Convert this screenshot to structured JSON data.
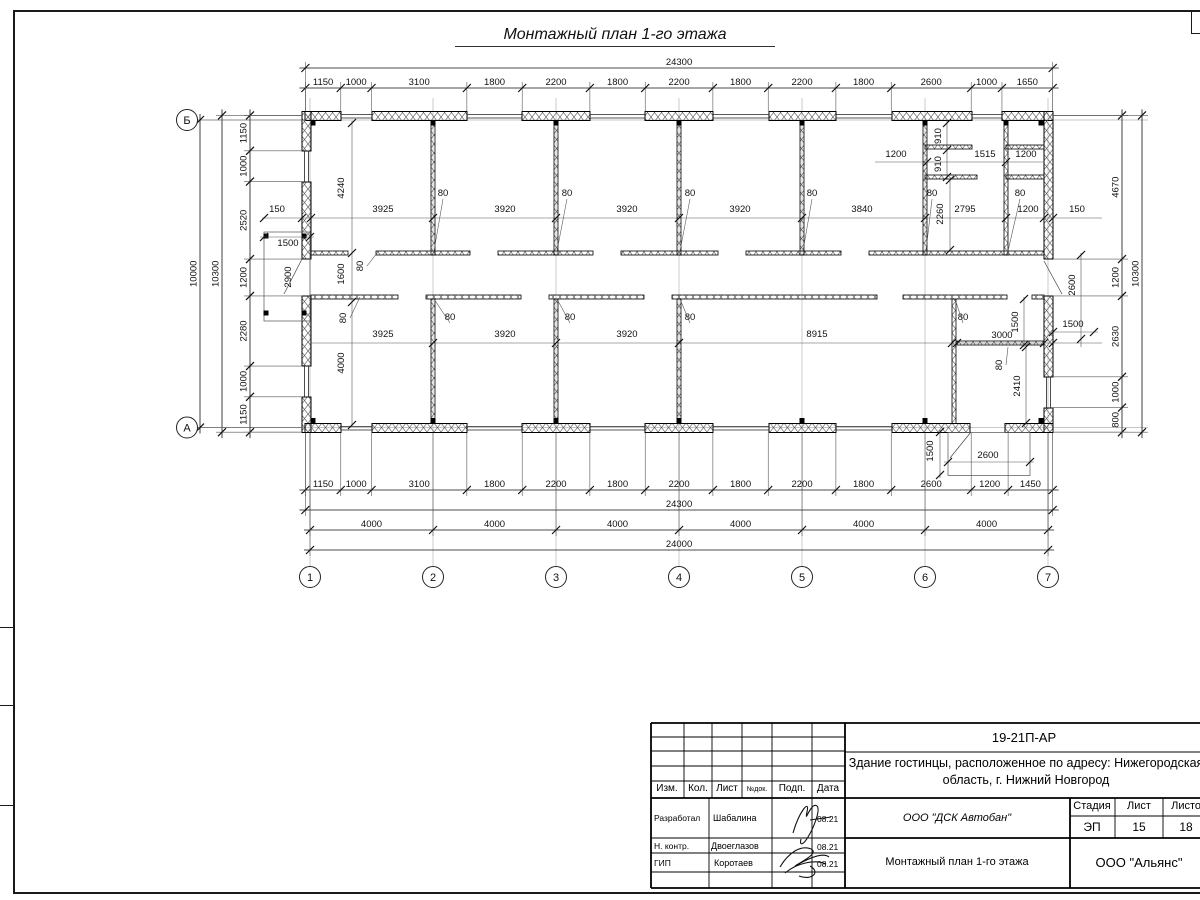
{
  "sheet": {
    "title": "Монтажный план 1-го этажа"
  },
  "plan": {
    "axes_bottom": [
      "1",
      "2",
      "3",
      "4",
      "5",
      "6",
      "7"
    ],
    "axes_left": [
      "Б",
      "А"
    ],
    "top_chain": [
      1150,
      1000,
      3100,
      1800,
      2200,
      1800,
      2200,
      1800,
      2200,
      1800,
      2600,
      1000,
      1650
    ],
    "top_total": 24300,
    "bottom_chain": [
      1150,
      1000,
      3100,
      1800,
      2200,
      1800,
      2200,
      1800,
      2200,
      1800,
      2600,
      1200,
      1450
    ],
    "bottom_total": 24300,
    "bottom_grid": [
      4000,
      4000,
      4000,
      4000,
      4000,
      4000
    ],
    "bottom_grid_total": 24000,
    "left_chain": [
      1150,
      1000,
      2520,
      1200,
      2280,
      1000,
      1150
    ],
    "left_total": 10300,
    "axis_span": 10000,
    "right_chain": [
      4670,
      1200,
      2630,
      1000,
      800
    ],
    "right_total": 10300,
    "free_labels": [
      {
        "t": "4240",
        "x": 344,
        "y": 188,
        "v": 1
      },
      {
        "t": "1600",
        "x": 344,
        "y": 274,
        "v": 1
      },
      {
        "t": "4000",
        "x": 344,
        "y": 363,
        "v": 1
      },
      {
        "t": "80",
        "x": 363,
        "y": 266,
        "v": 1,
        "l": [
          377,
          253
        ]
      },
      {
        "t": "80",
        "x": 346,
        "y": 318,
        "v": 1,
        "l": [
          360,
          297
        ]
      },
      {
        "t": "150",
        "x": 277,
        "y": 212
      },
      {
        "t": "1500",
        "x": 288,
        "y": 246
      },
      {
        "t": "2900",
        "x": 291,
        "y": 277,
        "v": 1
      },
      {
        "t": "3925",
        "x": 383,
        "y": 212
      },
      {
        "t": "80",
        "x": 443,
        "y": 196,
        "l": [
          434,
          251
        ]
      },
      {
        "t": "3920",
        "x": 505,
        "y": 212
      },
      {
        "t": "80",
        "x": 567,
        "y": 196,
        "l": [
          557,
          251
        ]
      },
      {
        "t": "3920",
        "x": 627,
        "y": 212
      },
      {
        "t": "80",
        "x": 690,
        "y": 196,
        "l": [
          680,
          251
        ]
      },
      {
        "t": "3920",
        "x": 740,
        "y": 212
      },
      {
        "t": "80",
        "x": 812,
        "y": 196,
        "l": [
          803,
          251
        ]
      },
      {
        "t": "3840",
        "x": 862,
        "y": 212
      },
      {
        "t": "80",
        "x": 932,
        "y": 196,
        "l": [
          926,
          251
        ]
      },
      {
        "t": "2795",
        "x": 965,
        "y": 212
      },
      {
        "t": "80",
        "x": 1020,
        "y": 196,
        "l": [
          1008,
          251
        ]
      },
      {
        "t": "1200",
        "x": 1028,
        "y": 212
      },
      {
        "t": "150",
        "x": 1077,
        "y": 212
      },
      {
        "t": "2260",
        "x": 943,
        "y": 214,
        "v": 1
      },
      {
        "t": "910",
        "x": 941,
        "y": 136,
        "v": 1
      },
      {
        "t": "910",
        "x": 941,
        "y": 164,
        "v": 1
      },
      {
        "t": "1200",
        "x": 896,
        "y": 157
      },
      {
        "t": "1515",
        "x": 985,
        "y": 157
      },
      {
        "t": "1200",
        "x": 1026,
        "y": 157
      },
      {
        "t": "3925",
        "x": 383,
        "y": 337
      },
      {
        "t": "80",
        "x": 450,
        "y": 320,
        "l": [
          434,
          299
        ]
      },
      {
        "t": "3920",
        "x": 505,
        "y": 337
      },
      {
        "t": "80",
        "x": 570,
        "y": 320,
        "l": [
          557,
          299
        ]
      },
      {
        "t": "3920",
        "x": 627,
        "y": 337
      },
      {
        "t": "80",
        "x": 690,
        "y": 320,
        "l": [
          680,
          299
        ]
      },
      {
        "t": "8915",
        "x": 817,
        "y": 337
      },
      {
        "t": "80",
        "x": 963,
        "y": 320,
        "l": [
          955,
          299
        ]
      },
      {
        "t": "3000",
        "x": 1002,
        "y": 338
      },
      {
        "t": "1500",
        "x": 1018,
        "y": 322,
        "v": 1
      },
      {
        "t": "2600",
        "x": 1075,
        "y": 285,
        "v": 1
      },
      {
        "t": "1500",
        "x": 1073,
        "y": 327
      },
      {
        "t": "80",
        "x": 1002,
        "y": 365,
        "v": 1,
        "l": [
          1008,
          347
        ]
      },
      {
        "t": "2410",
        "x": 1020,
        "y": 386,
        "v": 1
      },
      {
        "t": "1500",
        "x": 933,
        "y": 451,
        "v": 1
      },
      {
        "t": "2600",
        "x": 988,
        "y": 458
      }
    ]
  },
  "titleblock": {
    "doc_number": "19-21П-АР",
    "project_line1": "Здание гостинцы, расположенное по адресу: Нижегородская",
    "project_line2": "область, г. Нижний Новгород",
    "columns": [
      "Изм.",
      "Кол.",
      "Лист",
      "№док.",
      "Подп.",
      "Дата"
    ],
    "rows": [
      {
        "role": "Разработал",
        "name": "Шабалина",
        "date": "08.21"
      },
      {
        "role": "Н. контр.",
        "name": "Двоеглазов",
        "date": "08.21"
      },
      {
        "role": "ГИП",
        "name": "Коротаев",
        "date": "08.21"
      }
    ],
    "company": "ООО \"ДСК Автобан\"",
    "stage_label": "Стадия",
    "sheet_label": "Лист",
    "sheets_label": "Листов",
    "stage": "ЭП",
    "sheet": "15",
    "sheets": "18",
    "drawing_name": "Монтажный план 1-го этажа",
    "org": "ООО \"Альянс\""
  }
}
